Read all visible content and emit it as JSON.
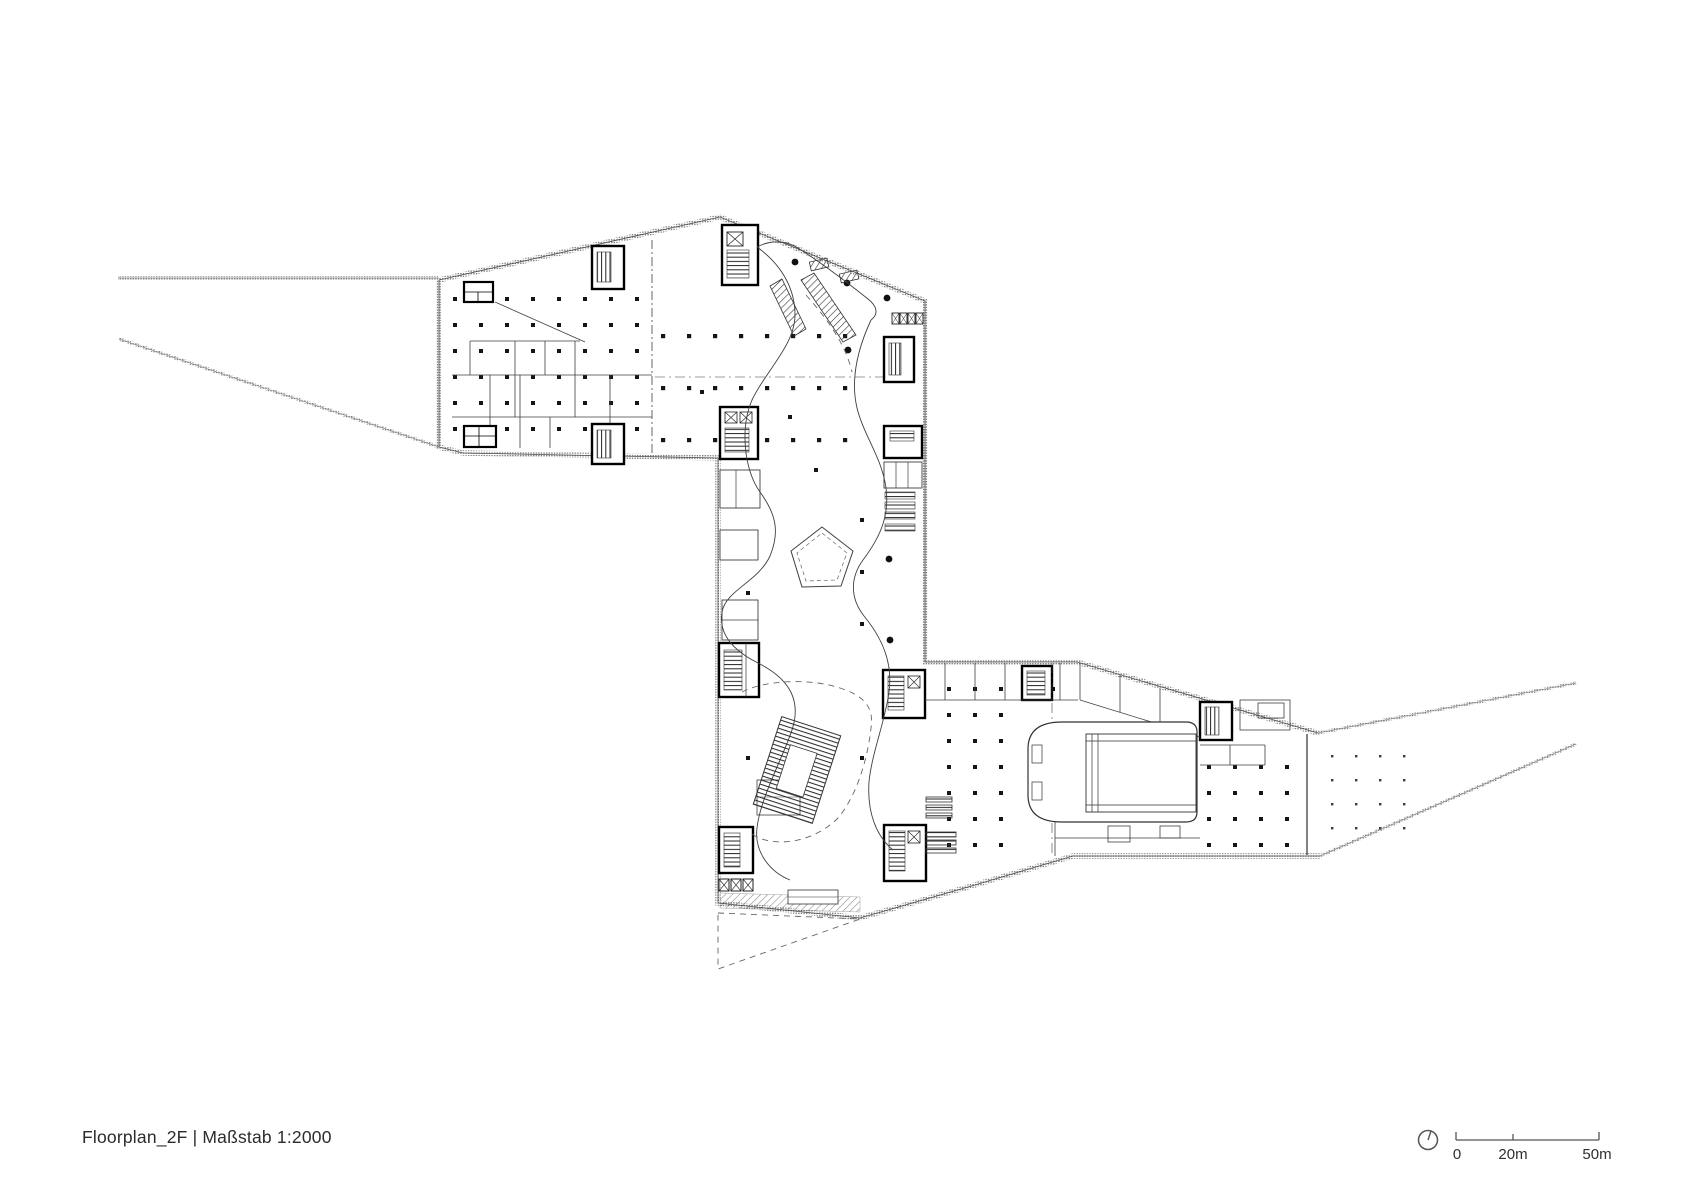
{
  "title": {
    "text": "Floorplan_2F | Maßstab 1:2000"
  },
  "drawing": {
    "kind": "architectural floor plan",
    "floor_label": "2F",
    "scale_label": "1:2000"
  },
  "scalebar": {
    "label_0": "0",
    "label_20": "20m",
    "label_50": "50m"
  },
  "icons": {
    "north": "north-orientation-icon"
  },
  "colors": {
    "ink": "#2f2f2f",
    "wall_gray": "#8f8f8f",
    "background": "#ffffff"
  }
}
